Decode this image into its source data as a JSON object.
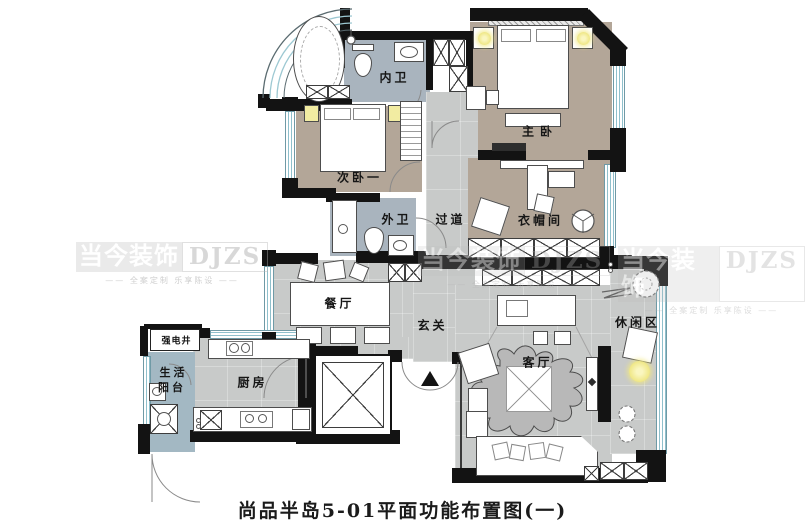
{
  "title": "尚品半岛5-01平面功能布置图(一)",
  "watermark": {
    "brand": "当今装饰",
    "abbr": "DJZS",
    "slogan": "—— 全案定制 乐享陈设 ——"
  },
  "rooms": {
    "inner_bath": "内卫",
    "master_bedroom": "主卧",
    "second_bedroom": "次卧一",
    "outer_bath": "外卫",
    "corridor": "过道",
    "cloakroom": "衣帽间",
    "dining": "餐厅",
    "foyer": "玄关",
    "leisure": "休闲区",
    "living": "客厅",
    "kitchen": "厨房",
    "balcony_line1": "生活",
    "balcony_line2": "阳台",
    "utility_shaft": "强电井"
  },
  "colors": {
    "wall": "#131313",
    "floor_gray": "#c8cac9",
    "floor_taupe": "#b3a698",
    "floor_bath": "#a9b4be",
    "floor_balcony": "#a3b8c3",
    "window": "#8fc0cc",
    "lamp": "#f0e88a"
  }
}
